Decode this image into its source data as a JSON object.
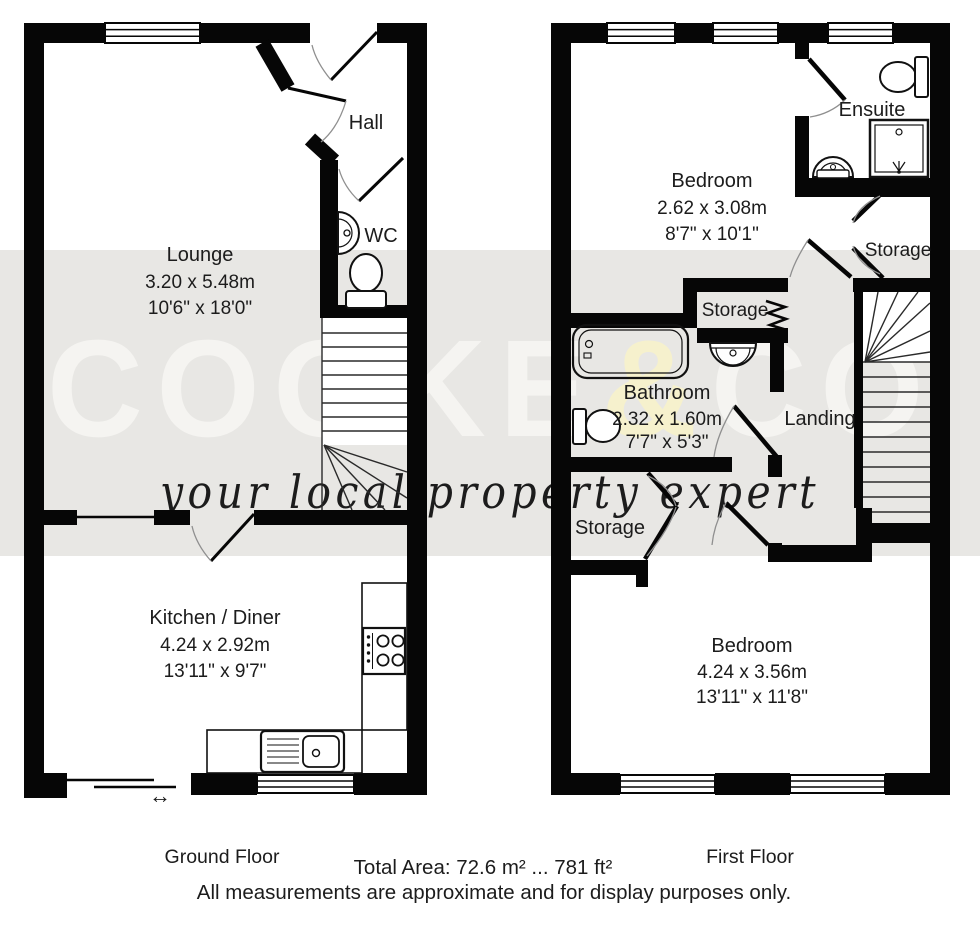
{
  "watermark": {
    "brand_left": "COOKE",
    "brand_amp": "&",
    "brand_right": "CO",
    "tagline": "your local property expert",
    "band_color": "#e8e7e4",
    "letter_color": "#f5f4f1",
    "amp_color": "#f6f1cd",
    "tagline_color": "#eee9cf"
  },
  "gf": {
    "title": "Ground Floor",
    "rooms": {
      "hall": {
        "name": "Hall"
      },
      "wc": {
        "name": "WC"
      },
      "lounge": {
        "name": "Lounge",
        "dims_m": "3.20 x 5.48m",
        "dims_ft": "10'6\" x 18'0\""
      },
      "kitchen": {
        "name": "Kitchen / Diner",
        "dims_m": "4.24 x 2.92m",
        "dims_ft": "13'11\" x 9'7\""
      }
    }
  },
  "ff": {
    "title": "First Floor",
    "rooms": {
      "bedroom1": {
        "name": "Bedroom",
        "dims_m": "2.62 x 3.08m",
        "dims_ft": "8'7\" x 10'1\""
      },
      "ensuite": {
        "name": "Ensuite"
      },
      "storage_top": {
        "name": "Storage"
      },
      "storage_mid": {
        "name": "Storage"
      },
      "bathroom": {
        "name": "Bathroom",
        "dims_m": "2.32 x 1.60m",
        "dims_ft": "7'7\" x 5'3\""
      },
      "landing": {
        "name": "Landing"
      },
      "storage_bottom": {
        "name": "Storage"
      },
      "bedroom2": {
        "name": "Bedroom",
        "dims_m": "4.24 x 3.56m",
        "dims_ft": "13'11\" x 11'8\""
      }
    }
  },
  "footer": {
    "total_area": "Total Area: 72.6 m² ... 781 ft²",
    "disclaimer": "All measurements are approximate and for display purposes only."
  },
  "icons": {
    "slider_arrow": "↔"
  }
}
